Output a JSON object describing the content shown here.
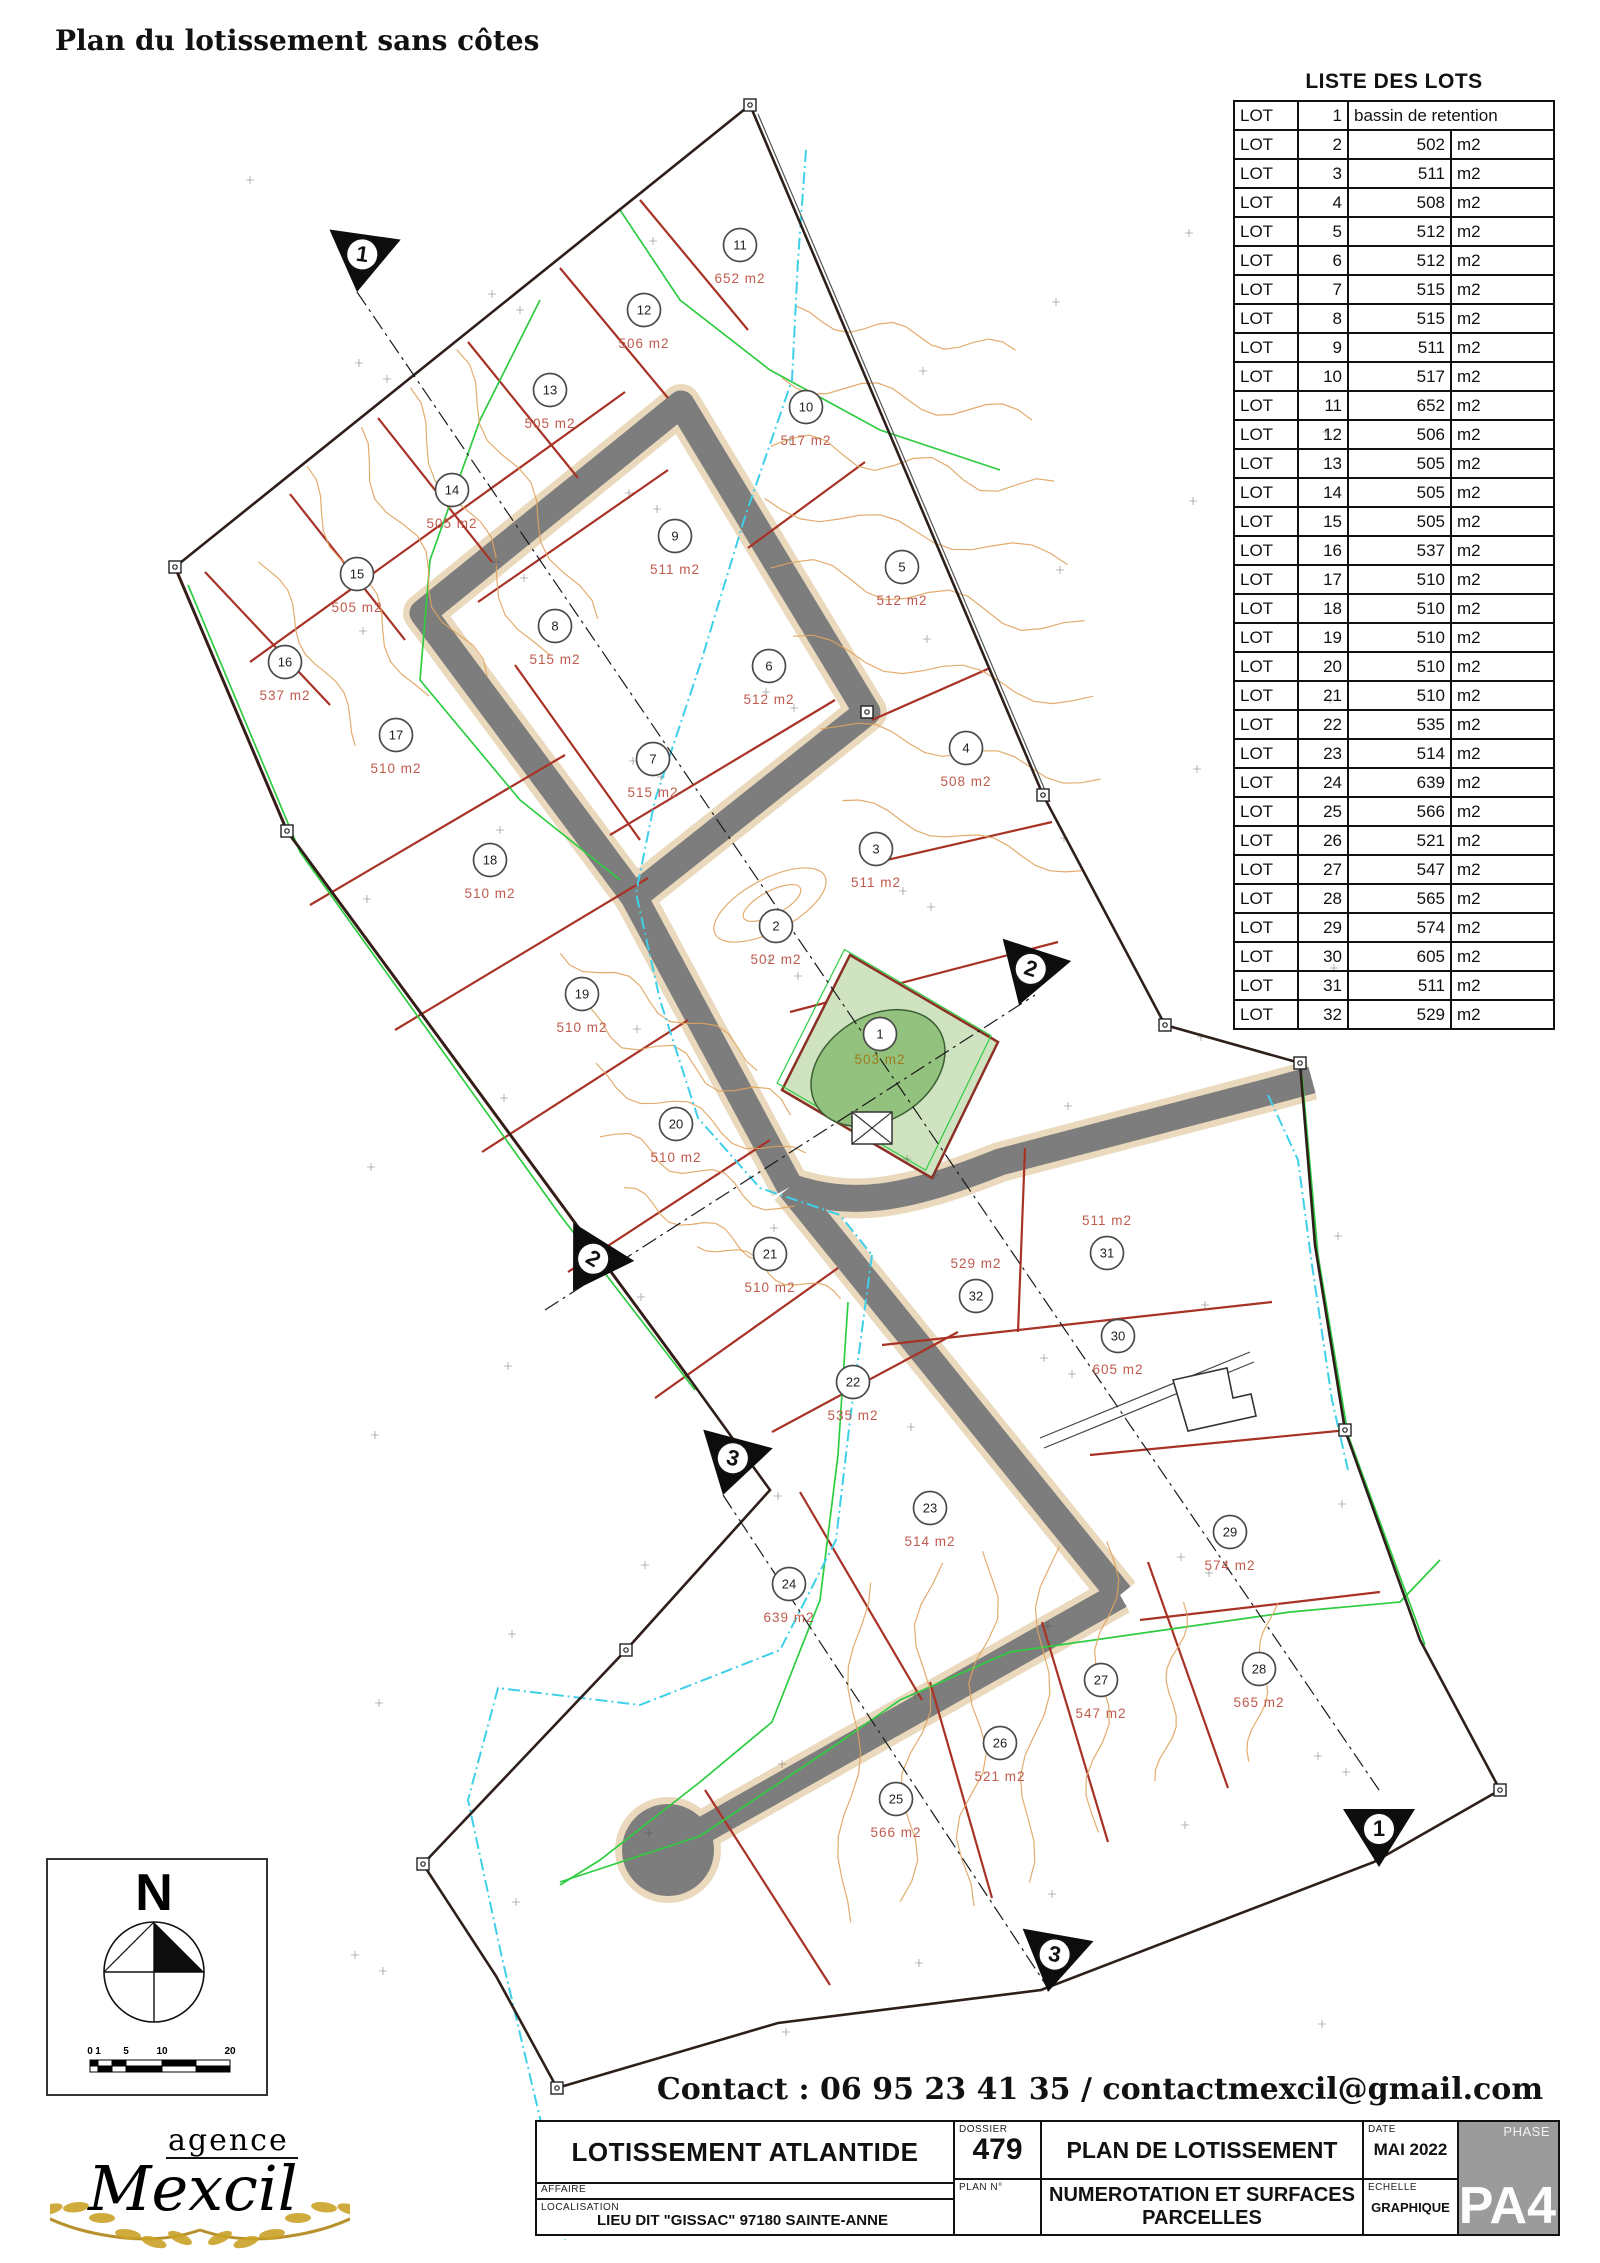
{
  "page": {
    "title": "Plan du lotissement sans côtes",
    "contact": "Contact : 06 95 23 41 35 / contactmexcil@gmail.com"
  },
  "lots_table": {
    "title": "LISTE DES LOTS",
    "row_label": "LOT",
    "unit": "m2",
    "rows": [
      {
        "n": "1",
        "a": "bassin de retention"
      },
      {
        "n": "2",
        "a": "502"
      },
      {
        "n": "3",
        "a": "511"
      },
      {
        "n": "4",
        "a": "508"
      },
      {
        "n": "5",
        "a": "512"
      },
      {
        "n": "6",
        "a": "512"
      },
      {
        "n": "7",
        "a": "515"
      },
      {
        "n": "8",
        "a": "515"
      },
      {
        "n": "9",
        "a": "511"
      },
      {
        "n": "10",
        "a": "517"
      },
      {
        "n": "11",
        "a": "652"
      },
      {
        "n": "12",
        "a": "506"
      },
      {
        "n": "13",
        "a": "505"
      },
      {
        "n": "14",
        "a": "505"
      },
      {
        "n": "15",
        "a": "505"
      },
      {
        "n": "16",
        "a": "537"
      },
      {
        "n": "17",
        "a": "510"
      },
      {
        "n": "18",
        "a": "510"
      },
      {
        "n": "19",
        "a": "510"
      },
      {
        "n": "20",
        "a": "510"
      },
      {
        "n": "21",
        "a": "510"
      },
      {
        "n": "22",
        "a": "535"
      },
      {
        "n": "23",
        "a": "514"
      },
      {
        "n": "24",
        "a": "639"
      },
      {
        "n": "25",
        "a": "566"
      },
      {
        "n": "26",
        "a": "521"
      },
      {
        "n": "27",
        "a": "547"
      },
      {
        "n": "28",
        "a": "565"
      },
      {
        "n": "29",
        "a": "574"
      },
      {
        "n": "30",
        "a": "605"
      },
      {
        "n": "31",
        "a": "511"
      },
      {
        "n": "32",
        "a": "529"
      }
    ]
  },
  "map": {
    "lots": [
      {
        "num": "1",
        "x": 880,
        "y": 1034,
        "label": "503 m2",
        "color": "#9c7c1e",
        "dy": 30
      },
      {
        "num": "2",
        "x": 776,
        "y": 926,
        "label": "502 m2"
      },
      {
        "num": "3",
        "x": 876,
        "y": 849,
        "label": "511 m2"
      },
      {
        "num": "4",
        "x": 966,
        "y": 748,
        "label": "508 m2"
      },
      {
        "num": "5",
        "x": 902,
        "y": 567,
        "label": "512 m2"
      },
      {
        "num": "6",
        "x": 769,
        "y": 666,
        "label": "512 m2"
      },
      {
        "num": "7",
        "x": 653,
        "y": 759,
        "label": "515 m2"
      },
      {
        "num": "8",
        "x": 555,
        "y": 626,
        "label": "515 m2"
      },
      {
        "num": "9",
        "x": 675,
        "y": 536,
        "label": "511 m2"
      },
      {
        "num": "10",
        "x": 806,
        "y": 407,
        "label": "517 m2"
      },
      {
        "num": "11",
        "x": 740,
        "y": 245,
        "label": "652 m2"
      },
      {
        "num": "12",
        "x": 644,
        "y": 310,
        "label": "506 m2"
      },
      {
        "num": "13",
        "x": 550,
        "y": 390,
        "label": "505 m2"
      },
      {
        "num": "14",
        "x": 452,
        "y": 490,
        "label": "505 m2"
      },
      {
        "num": "15",
        "x": 357,
        "y": 574,
        "label": "505 m2"
      },
      {
        "num": "16",
        "x": 285,
        "y": 662,
        "label": "537 m2"
      },
      {
        "num": "17",
        "x": 396,
        "y": 735,
        "label": "510 m2"
      },
      {
        "num": "18",
        "x": 490,
        "y": 860,
        "label": "510 m2"
      },
      {
        "num": "19",
        "x": 582,
        "y": 994,
        "label": "510 m2"
      },
      {
        "num": "20",
        "x": 676,
        "y": 1124,
        "label": "510 m2"
      },
      {
        "num": "21",
        "x": 770,
        "y": 1254,
        "label": "510 m2"
      },
      {
        "num": "22",
        "x": 853,
        "y": 1382,
        "label": "535 m2"
      },
      {
        "num": "23",
        "x": 930,
        "y": 1508,
        "label": "514 m2"
      },
      {
        "num": "24",
        "x": 789,
        "y": 1584,
        "label": "639 m2"
      },
      {
        "num": "25",
        "x": 896,
        "y": 1799,
        "label": "566 m2"
      },
      {
        "num": "26",
        "x": 1000,
        "y": 1743,
        "label": "521 m2"
      },
      {
        "num": "27",
        "x": 1101,
        "y": 1680,
        "label": "547 m2"
      },
      {
        "num": "28",
        "x": 1259,
        "y": 1669,
        "label": "565 m2"
      },
      {
        "num": "29",
        "x": 1230,
        "y": 1532,
        "label": "574 m2"
      },
      {
        "num": "30",
        "x": 1118,
        "y": 1336,
        "label": "605 m2"
      },
      {
        "num": "31",
        "x": 1107,
        "y": 1253,
        "label": "511 m2",
        "dy": -28
      },
      {
        "num": "32",
        "x": 976,
        "y": 1296,
        "label": "529 m2",
        "dy": -28
      }
    ],
    "flags": [
      {
        "label": "1",
        "x": 357,
        "y": 292,
        "rot": 8
      },
      {
        "label": "2",
        "x": 1019,
        "y": 1005,
        "rot": 18
      },
      {
        "label": "2",
        "x": 573,
        "y": 1291,
        "rot": 32
      },
      {
        "label": "3",
        "x": 723,
        "y": 1495,
        "rot": 15
      },
      {
        "label": "1",
        "x": 1379,
        "y": 1867,
        "rot": 0
      },
      {
        "label": "3",
        "x": 1048,
        "y": 1992,
        "rot": 10
      }
    ]
  },
  "north_box": {
    "n_label": "N",
    "scale_ticks": [
      "0",
      "1",
      "5",
      "10",
      "20"
    ]
  },
  "logo": {
    "line1": "agence",
    "line2": "Mexcil"
  },
  "title_block": {
    "project": "LOTISSEMENT ATLANTIDE",
    "affaire_label": "AFFAIRE",
    "localisation_label": "LOCALISATION",
    "localisation": "LIEU DIT \"GISSAC\" 97180 SAINTE-ANNE",
    "dossier_label": "DOSSIER",
    "dossier": "479",
    "plan_no_label": "PLAN N°",
    "doc_title": "PLAN DE LOTISSEMENT",
    "doc_subtitle": "NUMEROTATION ET SURFACES PARCELLES",
    "date_label": "DATE",
    "date": "MAI 2022",
    "echelle_label": "ECHELLE",
    "echelle": "GRAPHIQUE",
    "phase_label": "PHASE",
    "phase": "PA4"
  }
}
